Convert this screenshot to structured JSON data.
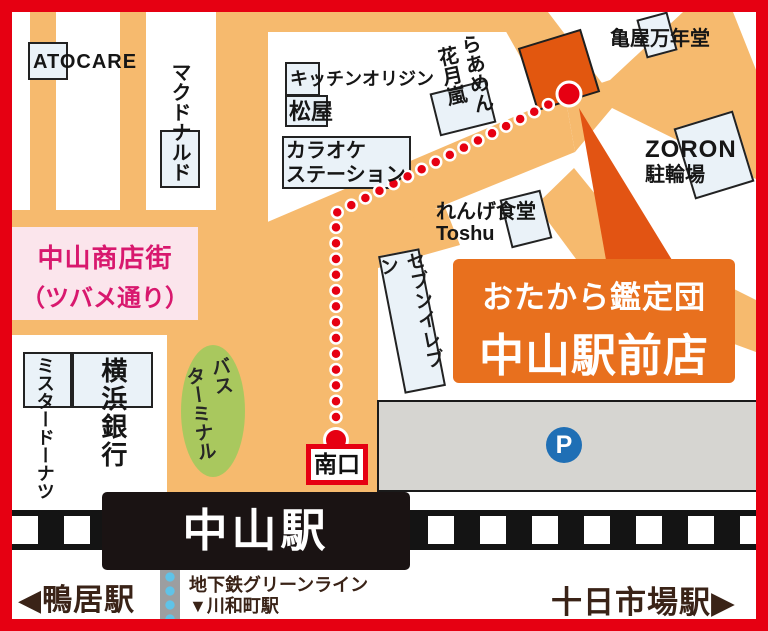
{
  "buildings": {
    "atocare": "ATOCARE",
    "mcdonalds": "マクドナルド",
    "kitchen_origin": "キッチンオリジン",
    "matsuya": "松屋",
    "karaoke_line1": "カラオケ",
    "karaoke_line2": "ステーション",
    "ramen_col_right": "らあめん",
    "ramen_col_left": "花月嵐",
    "kameya": "亀屋万年堂",
    "zoron_name": "ZORON",
    "zoron_sub": "駐輪場",
    "renge_line1": "れんげ食堂",
    "renge_line2": "Toshu",
    "seven_eleven": "セブンイレブン",
    "mister_donut": "ミスタードーナツ",
    "yokohama_bank": "横浜銀行"
  },
  "landmarks": {
    "shopping_street_line1": "中山商店街",
    "shopping_street_line2": "（ツバメ通り）",
    "bus_terminal_col_right": "バス",
    "bus_terminal_col_left": "ターミナル",
    "parking_symbol": "P",
    "south_exit": "南口"
  },
  "callout": {
    "line1": "おたから鑑定団",
    "line2": "中山駅前店"
  },
  "station": {
    "name": "中山駅"
  },
  "bottom_bar": {
    "left_arrow": "◀",
    "left_station": "鴨居駅",
    "right_station": "十日市場駅",
    "right_arrow": "▶",
    "subway_line": "地下鉄グリーンライン",
    "subway_next_station": "▼川和町駅"
  },
  "route": {
    "points": [
      [
        336,
        440
      ],
      [
        336,
        213
      ],
      [
        569,
        94
      ]
    ],
    "spacing": 15.8,
    "dot_radius": 5.5,
    "big_dot_radius": 12,
    "start_offset": 23,
    "end_offset": 23,
    "color": "#E60012",
    "outline": "#FFFFFF"
  },
  "colors": {
    "frame_red": "#E60012",
    "road_orange": "#F6BA6E",
    "building_fill": "#EAF2F8",
    "building_border": "#222222",
    "pink_bg": "#FBE5EC",
    "magenta_text": "#D8186E",
    "callout_orange": "#E8701E",
    "callout_tail": "#E25413",
    "destination_orange": "#E2570F",
    "bus_green": "#A9C85E",
    "parking_gray": "#D6D5D1",
    "parking_blue": "#1F6FB5",
    "station_black": "#1A1313",
    "track_black": "#141414",
    "brown_text": "#3A2317",
    "subway_strip_gray": "#9C9EA0",
    "subway_dot_blue": "#5FC3E8"
  }
}
